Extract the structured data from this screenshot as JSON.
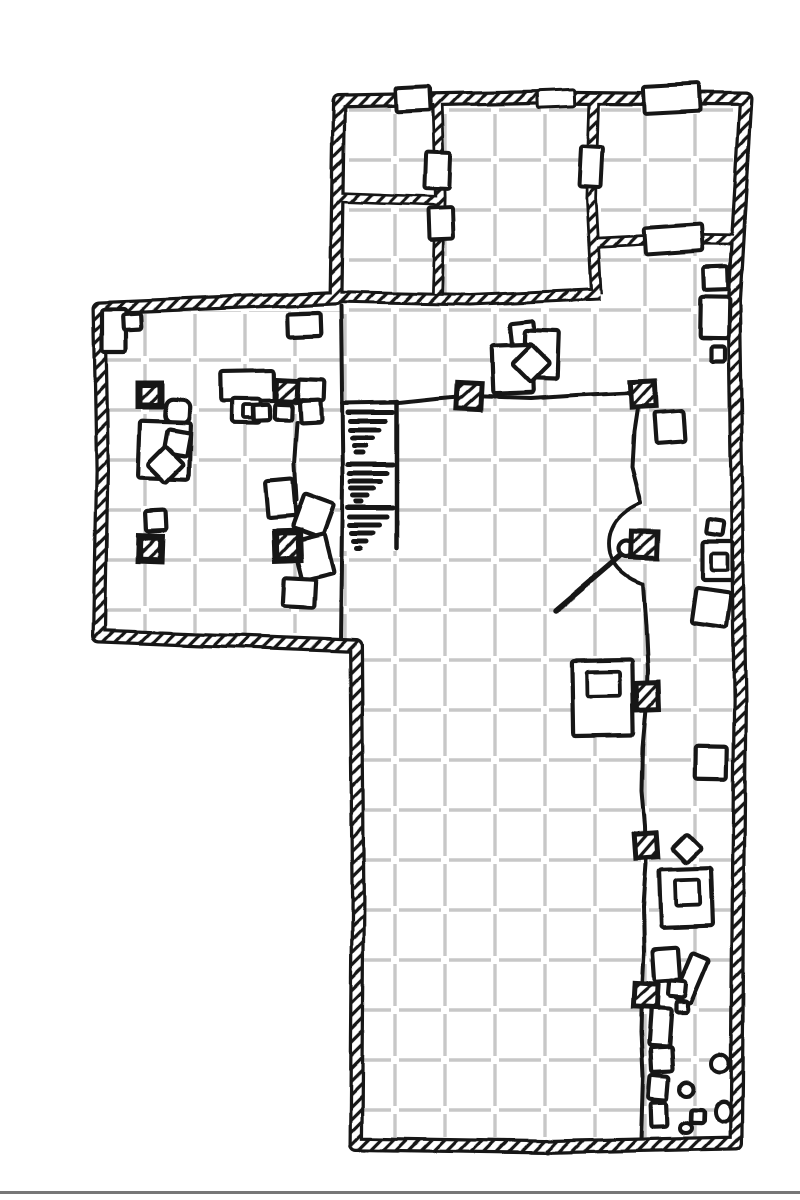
{
  "map": {
    "canvas": {
      "width": 800,
      "height": 1200
    },
    "colors": {
      "ink": "#151515",
      "grid": "#c7c7c7",
      "paper": "#ffffff",
      "page_edge": "#555555"
    },
    "grid": {
      "cell": 50,
      "offset_x": 20,
      "offset_y": 35,
      "dash_gap": 8,
      "line_width": 3.4
    },
    "floors": [
      {
        "n": "room-a-floor",
        "rect": [
          347,
          108,
          85,
          88
        ]
      },
      {
        "n": "room-b-floor",
        "rect": [
          347,
          206,
          85,
          86
        ]
      },
      {
        "n": "room-c-floor",
        "rect": [
          444,
          108,
          144,
          185
        ]
      },
      {
        "n": "room-d-floor",
        "rect": [
          601,
          108,
          132,
          128
        ]
      },
      {
        "n": "west-wing-floor",
        "rect": [
          107,
          311,
          235,
          322
        ]
      },
      {
        "n": "main-hall-floor",
        "poly": [
          [
            342,
            308
          ],
          [
            601,
            306
          ],
          [
            601,
            247
          ],
          [
            732,
            247
          ],
          [
            732,
            1137
          ],
          [
            362,
            1137
          ],
          [
            362,
            650
          ],
          [
            342,
            644
          ]
        ]
      }
    ],
    "stair_shaft": {
      "rect": [
        344,
        405,
        52,
        146
      ]
    },
    "stairs": {
      "n": "staircase-down",
      "steps": [
        [
          348,
          393,
          412
        ],
        [
          350,
          386,
          421
        ],
        [
          350,
          380,
          430
        ],
        [
          352,
          373,
          438
        ],
        [
          354,
          366,
          446
        ],
        [
          356,
          363,
          453
        ],
        [
          348,
          393,
          465
        ],
        [
          350,
          387,
          474
        ],
        [
          351,
          381,
          482
        ],
        [
          352,
          374,
          489
        ],
        [
          354,
          368,
          496
        ],
        [
          357,
          362,
          502
        ],
        [
          348,
          393,
          508
        ],
        [
          350,
          387,
          517
        ],
        [
          350,
          380,
          525
        ],
        [
          352,
          374,
          533
        ],
        [
          354,
          367,
          541
        ],
        [
          357,
          361,
          548
        ]
      ],
      "line_width": 5
    },
    "thin_lines": [
      {
        "n": "wing-partition-line",
        "w": 4,
        "pts": [
          [
            341,
            306
          ],
          [
            343,
            480
          ],
          [
            341,
            641
          ]
        ]
      },
      {
        "n": "stair-shaft-top-line",
        "w": 4,
        "pts": [
          [
            342,
            403
          ],
          [
            397,
            402
          ]
        ]
      },
      {
        "n": "stair-shaft-right-line",
        "w": 4.5,
        "pts": [
          [
            397,
            402
          ],
          [
            397,
            548
          ]
        ]
      },
      {
        "n": "rope-line-horizontal",
        "w": 4,
        "pts": [
          [
            399,
            403
          ],
          [
            436,
            399
          ],
          [
            470,
            396
          ],
          [
            531,
            398
          ],
          [
            576,
            395
          ],
          [
            640,
            392
          ]
        ]
      },
      {
        "n": "rope-line-upper",
        "w": 4,
        "pts": [
          [
            640,
            392
          ],
          [
            634,
            432
          ],
          [
            632,
            467
          ],
          [
            641,
            503
          ]
        ]
      },
      {
        "n": "rope-line-lower",
        "w": 4,
        "pts": [
          [
            643,
            584
          ],
          [
            646,
            627
          ],
          [
            648,
            670
          ],
          [
            647,
            703
          ],
          [
            643,
            747
          ],
          [
            642,
            792
          ],
          [
            645,
            827
          ],
          [
            646,
            864
          ],
          [
            643,
            907
          ],
          [
            644,
            952
          ],
          [
            642,
            992
          ],
          [
            641,
            1032
          ],
          [
            643,
            1077
          ],
          [
            641,
            1140
          ]
        ]
      },
      {
        "n": "wing-rope-line",
        "w": 4,
        "pts": [
          [
            297,
            422
          ],
          [
            294,
            465
          ],
          [
            296,
            500
          ]
        ]
      }
    ],
    "arc_paths": [
      {
        "n": "door-arc",
        "w": 3.8,
        "d": "M641,503 C622,511 609,525 609,544 C609,563 622,577 643,584"
      }
    ],
    "pole": {
      "n": "lever-pole",
      "w": 5.5,
      "pts": [
        [
          624,
          553
        ],
        [
          556,
          611
        ]
      ],
      "knob": {
        "cx": 627,
        "cy": 549,
        "r": 8
      }
    },
    "walls": {
      "outer": {
        "n": "outer-wall",
        "w": 15,
        "hatch_w": 8.5,
        "closed": true,
        "pts": [
          [
            339,
            101
          ],
          [
            540,
            97
          ],
          [
            746,
            99
          ],
          [
            734,
            300
          ],
          [
            740,
            700
          ],
          [
            736,
            1143
          ],
          [
            545,
            1147
          ],
          [
            356,
            1144
          ],
          [
            358,
            900
          ],
          [
            356,
            646
          ],
          [
            200,
            640
          ],
          [
            99,
            636
          ],
          [
            102,
            470
          ],
          [
            99,
            308
          ],
          [
            220,
            303
          ],
          [
            336,
            298
          ]
        ]
      },
      "inner": [
        {
          "n": "hall-top-wall",
          "w": 13,
          "hatch_w": 7,
          "pts": [
            [
              333,
              297
            ],
            [
              470,
              300
            ],
            [
              600,
              294
            ]
          ]
        },
        {
          "n": "room-ac-wall",
          "w": 12,
          "hatch_w": 6.5,
          "pts": [
            [
              437,
              101
            ],
            [
              440,
              198
            ],
            [
              437,
              294
            ]
          ]
        },
        {
          "n": "room-ab-wall",
          "w": 11,
          "hatch_w": 6,
          "pts": [
            [
              335,
              197
            ],
            [
              437,
              201
            ]
          ]
        },
        {
          "n": "room-cd-wall",
          "w": 12,
          "hatch_w": 6.5,
          "pts": [
            [
              594,
              101
            ],
            [
              591,
              198
            ],
            [
              596,
              294
            ]
          ]
        },
        {
          "n": "room-d-south-wall",
          "w": 12,
          "hatch_w": 6.5,
          "pts": [
            [
              592,
              243
            ],
            [
              665,
              239
            ],
            [
              739,
              240
            ]
          ]
        }
      ]
    },
    "doors": [
      {
        "n": "door-top-right",
        "x": 643,
        "y": 85,
        "w": 58,
        "h": 27,
        "r": -3,
        "sw": 4
      },
      {
        "n": "door-room-a-top",
        "x": 396,
        "y": 87,
        "w": 34,
        "h": 24,
        "r": -3,
        "sw": 4
      },
      {
        "n": "wall-gap-top",
        "x": 537,
        "y": 90,
        "w": 38,
        "h": 17,
        "r": -2,
        "sw": 3
      },
      {
        "n": "door-room-a-c",
        "x": 425,
        "y": 152,
        "w": 25,
        "h": 37,
        "r": 2,
        "sw": 4
      },
      {
        "n": "door-room-b-c",
        "x": 429,
        "y": 208,
        "w": 24,
        "h": 31,
        "r": -2,
        "sw": 4
      },
      {
        "n": "door-room-c-d",
        "x": 580,
        "y": 147,
        "w": 22,
        "h": 40,
        "r": 3,
        "sw": 4
      },
      {
        "n": "door-room-d-hall",
        "x": 644,
        "y": 226,
        "w": 58,
        "h": 27,
        "r": -4,
        "sw": 4
      }
    ],
    "pillars": [
      {
        "n": "pillar",
        "x": 139,
        "y": 384,
        "w": 22,
        "h": 22,
        "r": 0,
        "heavy": true
      },
      {
        "n": "pillar",
        "x": 277,
        "y": 380,
        "w": 21,
        "h": 21,
        "r": 3,
        "heavy": false
      },
      {
        "n": "pillar",
        "x": 276,
        "y": 532,
        "w": 23,
        "h": 27,
        "r": -2,
        "heavy": true
      },
      {
        "n": "pillar",
        "x": 139,
        "y": 537,
        "w": 22,
        "h": 23,
        "r": 2,
        "heavy": true
      },
      {
        "n": "pillar",
        "x": 457,
        "y": 383,
        "w": 24,
        "h": 26,
        "r": 3,
        "heavy": false
      },
      {
        "n": "pillar",
        "x": 631,
        "y": 381,
        "w": 24,
        "h": 26,
        "r": -3,
        "heavy": false
      },
      {
        "n": "pillar",
        "x": 632,
        "y": 532,
        "w": 26,
        "h": 26,
        "r": 2,
        "heavy": false
      },
      {
        "n": "pillar",
        "x": 637,
        "y": 683,
        "w": 22,
        "h": 26,
        "r": -2,
        "heavy": false
      },
      {
        "n": "pillar",
        "x": 635,
        "y": 834,
        "w": 22,
        "h": 24,
        "r": -4,
        "heavy": false
      },
      {
        "n": "pillar",
        "x": 634,
        "y": 983,
        "w": 24,
        "h": 24,
        "r": 3,
        "heavy": false
      }
    ],
    "furniture": [
      {
        "n": "crate",
        "x": 102,
        "y": 309,
        "w": 24,
        "h": 44,
        "r": 0
      },
      {
        "n": "crate",
        "x": 123,
        "y": 314,
        "w": 18,
        "h": 16,
        "r": -3
      },
      {
        "n": "shelf",
        "x": 287,
        "y": 313,
        "w": 34,
        "h": 23,
        "r": -2
      },
      {
        "n": "seat",
        "x": 166,
        "y": 400,
        "w": 24,
        "h": 23,
        "r": 3,
        "round": true
      },
      {
        "n": "table",
        "x": 221,
        "y": 371,
        "w": 54,
        "h": 30,
        "r": -1
      },
      {
        "n": "chest",
        "x": 232,
        "y": 399,
        "w": 28,
        "h": 24,
        "r": 1,
        "inner": [
          11,
          6,
          13,
          13
        ]
      },
      {
        "n": "crate",
        "x": 298,
        "y": 379,
        "w": 26,
        "h": 21,
        "r": 2
      },
      {
        "n": "crate",
        "x": 300,
        "y": 400,
        "w": 21,
        "h": 22,
        "r": -3
      },
      {
        "n": "crate",
        "x": 253,
        "y": 405,
        "w": 17,
        "h": 16,
        "r": -2
      },
      {
        "n": "crate",
        "x": 275,
        "y": 404,
        "w": 17,
        "h": 16,
        "r": 2
      },
      {
        "n": "table",
        "x": 139,
        "y": 422,
        "w": 51,
        "h": 57,
        "r": 2
      },
      {
        "n": "seat",
        "x": 166,
        "y": 431,
        "w": 23,
        "h": 24,
        "r": 10
      },
      {
        "n": "seat-diamond",
        "x": 153,
        "y": 452,
        "w": 26,
        "h": 26,
        "r": 45
      },
      {
        "n": "crate",
        "x": 146,
        "y": 511,
        "w": 20,
        "h": 20,
        "r": -3
      },
      {
        "n": "crate",
        "x": 266,
        "y": 480,
        "w": 28,
        "h": 37,
        "r": -5
      },
      {
        "n": "crate",
        "x": 297,
        "y": 498,
        "w": 32,
        "h": 36,
        "r": 20
      },
      {
        "n": "crate",
        "x": 297,
        "y": 537,
        "w": 33,
        "h": 40,
        "r": -14
      },
      {
        "n": "crate",
        "x": 284,
        "y": 578,
        "w": 31,
        "h": 29,
        "r": 3
      },
      {
        "n": "seat",
        "x": 511,
        "y": 322,
        "w": 24,
        "h": 24,
        "r": -6
      },
      {
        "n": "table",
        "x": 524,
        "y": 331,
        "w": 34,
        "h": 47,
        "r": 2
      },
      {
        "n": "table",
        "x": 492,
        "y": 345,
        "w": 41,
        "h": 48,
        "r": -2
      },
      {
        "n": "seat-diamond",
        "x": 517,
        "y": 350,
        "w": 27,
        "h": 27,
        "r": 45
      },
      {
        "n": "shelf",
        "x": 704,
        "y": 267,
        "w": 24,
        "h": 23,
        "r": -2
      },
      {
        "n": "shelf",
        "x": 700,
        "y": 297,
        "w": 29,
        "h": 41,
        "r": 1
      },
      {
        "n": "crate",
        "x": 711,
        "y": 346,
        "w": 14,
        "h": 15,
        "r": 0
      },
      {
        "n": "crate",
        "x": 655,
        "y": 412,
        "w": 30,
        "h": 31,
        "r": -4
      },
      {
        "n": "crate",
        "x": 706,
        "y": 519,
        "w": 17,
        "h": 15,
        "r": 8
      },
      {
        "n": "chest",
        "x": 702,
        "y": 541,
        "w": 31,
        "h": 39,
        "r": 0,
        "inner": [
          9,
          12,
          17,
          17
        ]
      },
      {
        "n": "crate",
        "x": 693,
        "y": 590,
        "w": 36,
        "h": 36,
        "r": 8
      },
      {
        "n": "altar",
        "x": 572,
        "y": 661,
        "w": 61,
        "h": 74,
        "r": -1,
        "inner": [
          15,
          11,
          33,
          24
        ]
      },
      {
        "n": "crate",
        "x": 695,
        "y": 746,
        "w": 32,
        "h": 33,
        "r": 1
      },
      {
        "n": "seat-diamond",
        "x": 676,
        "y": 838,
        "w": 21,
        "h": 21,
        "r": 45
      },
      {
        "n": "altar",
        "x": 660,
        "y": 869,
        "w": 52,
        "h": 58,
        "r": -2,
        "inner": [
          16,
          11,
          24,
          26
        ]
      },
      {
        "n": "crate",
        "x": 654,
        "y": 948,
        "w": 26,
        "h": 32,
        "r": -4
      },
      {
        "n": "crate",
        "x": 683,
        "y": 954,
        "w": 18,
        "h": 48,
        "r": 23
      },
      {
        "n": "crate",
        "x": 669,
        "y": 980,
        "w": 17,
        "h": 16,
        "r": 5
      },
      {
        "n": "crate",
        "x": 676,
        "y": 1001,
        "w": 12,
        "h": 11,
        "r": 0
      },
      {
        "n": "crate",
        "x": 650,
        "y": 1008,
        "w": 20,
        "h": 38,
        "r": 4
      },
      {
        "n": "crate",
        "x": 651,
        "y": 1047,
        "w": 21,
        "h": 25,
        "r": -3
      },
      {
        "n": "crate",
        "x": 649,
        "y": 1076,
        "w": 19,
        "h": 24,
        "r": 5
      },
      {
        "n": "crate",
        "x": 651,
        "y": 1103,
        "w": 16,
        "h": 24,
        "r": -2
      },
      {
        "n": "crate",
        "x": 691,
        "y": 1110,
        "w": 13,
        "h": 13,
        "r": 2
      }
    ],
    "rocks": [
      {
        "n": "rock",
        "cx": 720,
        "cy": 1063,
        "rx": 9,
        "ry": 9
      },
      {
        "n": "rock",
        "cx": 687,
        "cy": 1089,
        "rx": 7,
        "ry": 7
      },
      {
        "n": "rock",
        "cx": 723,
        "cy": 1112,
        "rx": 8,
        "ry": 10
      },
      {
        "n": "rock",
        "cx": 686,
        "cy": 1128,
        "rx": 6,
        "ry": 5
      }
    ],
    "page_edge": {
      "n": "page-edge-line",
      "y": 1191,
      "h": 3,
      "opacity": 0.8
    }
  }
}
